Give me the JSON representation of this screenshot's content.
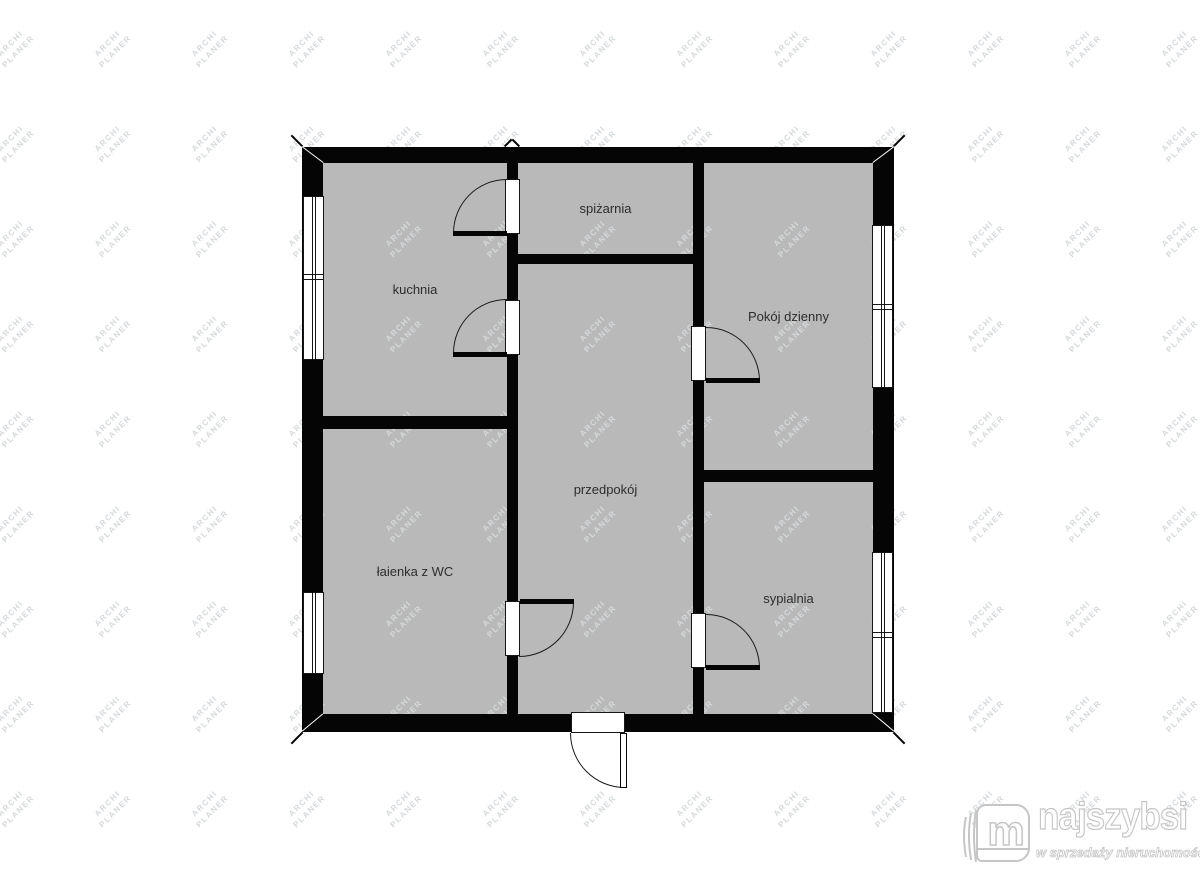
{
  "watermark": {
    "line1": "ARCHI",
    "line2": "PLANER"
  },
  "floor_plan": {
    "rooms": [
      {
        "name": "kuchnia",
        "label": "kuchnia"
      },
      {
        "name": "spizarnia",
        "label": "spiżarnia"
      },
      {
        "name": "pokoj-dzienny",
        "label": "Pokój dzienny"
      },
      {
        "name": "przedpokoj",
        "label": "przedpokój"
      },
      {
        "name": "lazienka",
        "label": "łaienka z WC"
      },
      {
        "name": "sypialnia",
        "label": "sypialnia"
      }
    ],
    "colors": {
      "wall": "#050505",
      "floor_fill": "#b9b9b9",
      "watermark_text": "#d5d9db",
      "label_text": "#2d2d2d",
      "logo_outline": "#c6c6c6"
    }
  },
  "logo": {
    "brand": "najszybsi",
    "tagline": "w sprzedaży nieruchomości"
  }
}
